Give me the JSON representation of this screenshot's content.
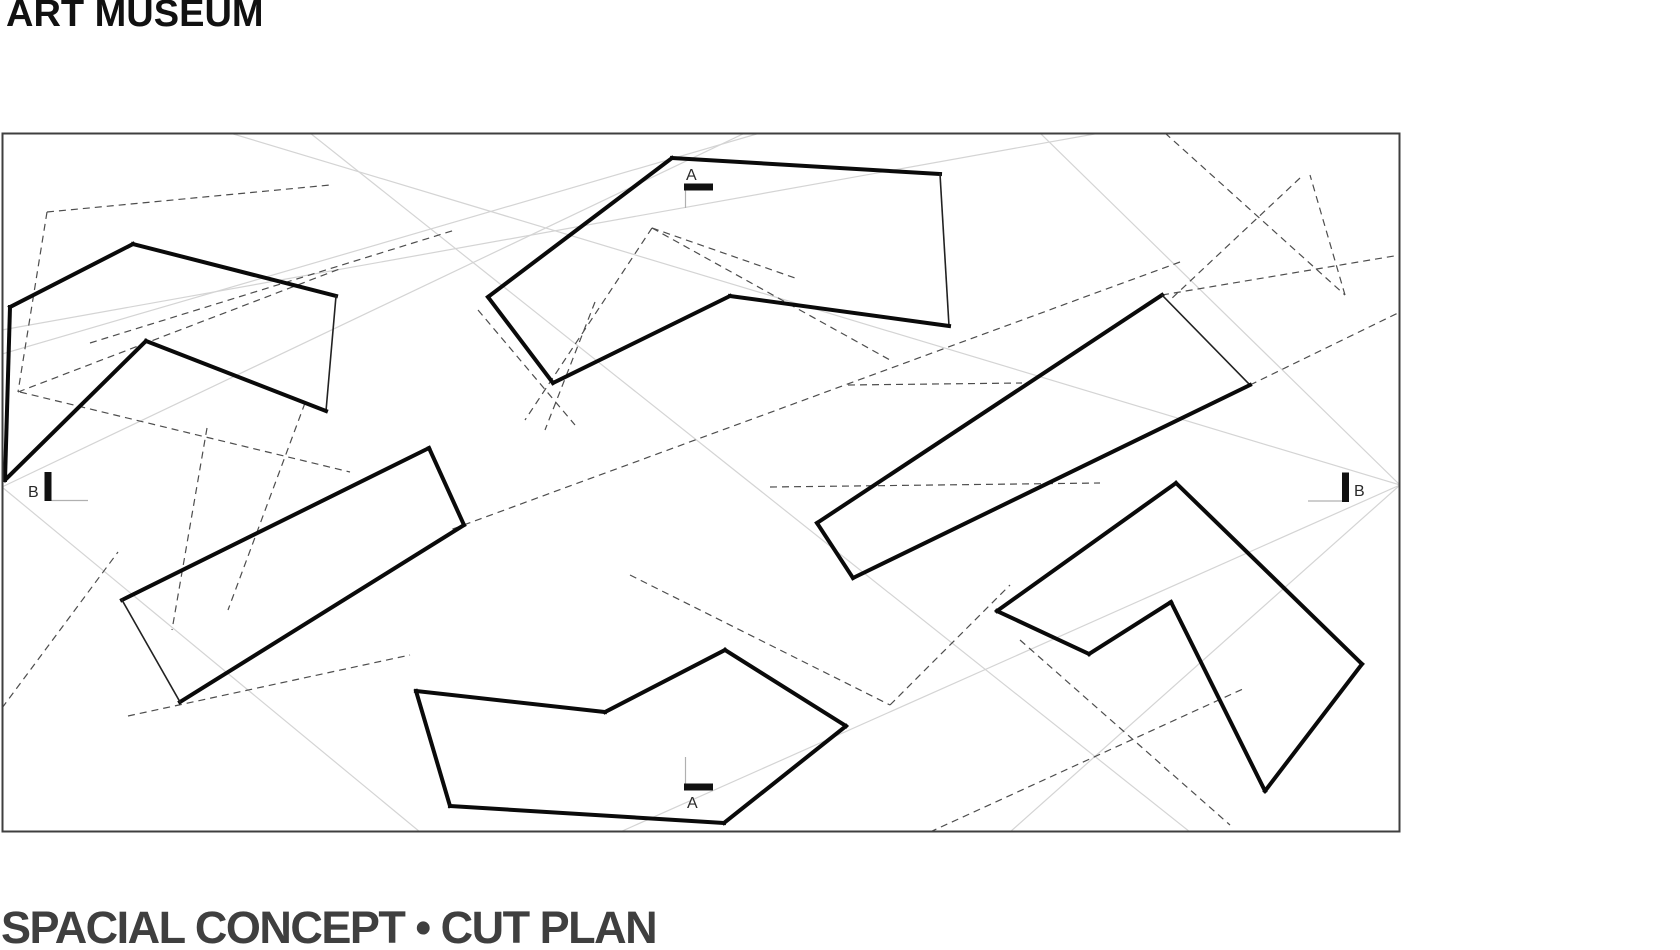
{
  "title": "ART MUSEUM",
  "caption": "SPACIAL CONCEPT • CUT PLAN",
  "colors": {
    "background": "#ffffff",
    "title_text": "#111111",
    "caption_text": "#3f3f3f",
    "frame_stroke": "#3f3f3f",
    "shape_bold_stroke": "#0a0a0a",
    "shape_thin_stroke": "#222222",
    "dashed_line": "#4d4d4d",
    "light_line": "#d4d4d4",
    "marker_bar": "#111111",
    "marker_text": "#2a2a2a",
    "marker_tick": "#b0b0b0"
  },
  "drawing": {
    "canvas": {
      "width": 1680,
      "height": 950
    },
    "frame": {
      "x": 2.5,
      "y": 133.5,
      "width": 1397,
      "height": 698
    },
    "stroke_widths": {
      "bold": 4,
      "thin": 1.6,
      "dashed": 1.2,
      "light": 1.2,
      "frame": 2
    },
    "dash_pattern": "7,5",
    "shapes": [
      {
        "name": "gallery-volume-northwest",
        "vertices": [
          [
            10,
            307
          ],
          [
            133,
            244
          ],
          [
            336,
            296
          ],
          [
            326,
            411
          ],
          [
            146,
            341
          ],
          [
            5,
            480
          ]
        ],
        "thin_edges": [
          2
        ]
      },
      {
        "name": "gallery-volume-north",
        "vertices": [
          [
            672,
            158
          ],
          [
            940,
            174
          ],
          [
            949,
            326
          ],
          [
            730,
            296
          ],
          [
            553,
            383
          ],
          [
            488,
            297
          ]
        ],
        "thin_edges": [
          1
        ]
      },
      {
        "name": "gallery-volume-west",
        "vertices": [
          [
            122,
            600
          ],
          [
            429,
            448
          ],
          [
            464,
            525
          ],
          [
            180,
            702
          ]
        ],
        "thin_edges": [
          3
        ]
      },
      {
        "name": "gallery-volume-east-bar",
        "vertices": [
          [
            817,
            523
          ],
          [
            1162,
            295
          ],
          [
            1250,
            385
          ],
          [
            853,
            578
          ]
        ],
        "thin_edges": [
          1
        ]
      },
      {
        "name": "gallery-volume-southeast",
        "vertices": [
          [
            997,
            611
          ],
          [
            1176,
            483
          ],
          [
            1362,
            664
          ],
          [
            1265,
            791
          ],
          [
            1171,
            602
          ],
          [
            1089,
            654
          ]
        ],
        "thin_edges": []
      },
      {
        "name": "gallery-volume-south",
        "vertices": [
          [
            416,
            691
          ],
          [
            605,
            712
          ],
          [
            725,
            650
          ],
          [
            846,
            726
          ],
          [
            724,
            823
          ],
          [
            450,
            806
          ]
        ],
        "thin_edges": []
      }
    ],
    "light_lines": [
      [
        2,
        487,
        745,
        133
      ],
      [
        2,
        487,
        420,
        832
      ],
      [
        310,
        133,
        1190,
        832
      ],
      [
        1040,
        133,
        1400,
        485
      ],
      [
        2,
        330,
        1100,
        133
      ],
      [
        1400,
        485,
        620,
        832
      ],
      [
        1400,
        485,
        1010,
        832
      ],
      [
        230,
        133,
        1400,
        485
      ],
      [
        2,
        354,
        760,
        133
      ]
    ],
    "dashed_lines": [
      [
        47,
        212,
        18,
        392
      ],
      [
        18,
        392,
        342,
        268
      ],
      [
        47,
        212,
        330,
        185
      ],
      [
        90,
        343,
        455,
        230
      ],
      [
        20,
        392,
        350,
        472
      ],
      [
        652,
        228,
        525,
        420
      ],
      [
        652,
        228,
        795,
        278
      ],
      [
        652,
        228,
        890,
        360
      ],
      [
        1180,
        262,
        450,
        530
      ],
      [
        848,
        385,
        1022,
        383
      ],
      [
        770,
        487,
        1100,
        483
      ],
      [
        630,
        575,
        890,
        705
      ],
      [
        890,
        705,
        1010,
        585
      ],
      [
        930,
        832,
        1245,
        688
      ],
      [
        1020,
        640,
        1230,
        825
      ],
      [
        1165,
        133,
        1345,
        295
      ],
      [
        1345,
        295,
        1310,
        175
      ],
      [
        1300,
        178,
        1170,
        300
      ],
      [
        1250,
        385,
        1400,
        312
      ],
      [
        1162,
        295,
        1400,
        255
      ],
      [
        207,
        428,
        172,
        630
      ],
      [
        305,
        403,
        228,
        610
      ],
      [
        128,
        716,
        410,
        655
      ],
      [
        595,
        302,
        545,
        430
      ],
      [
        478,
        310,
        575,
        425
      ],
      [
        2,
        708,
        118,
        552
      ]
    ],
    "section_markers": [
      {
        "id": "section-marker-a-top",
        "label": "A",
        "label_x": 686,
        "label_y": 180,
        "bar": {
          "x": 684,
          "y": 183.5,
          "width": 29,
          "height": 7
        },
        "tick": [
          685.5,
          190.5,
          685.5,
          208
        ]
      },
      {
        "id": "section-marker-a-bottom",
        "label": "A",
        "label_x": 687,
        "label_y": 808,
        "bar": {
          "x": 684,
          "y": 783.5,
          "width": 29,
          "height": 7
        },
        "tick": [
          685.5,
          757,
          685.5,
          783.5
        ]
      },
      {
        "id": "section-marker-b-left",
        "label": "B",
        "label_x": 28,
        "label_y": 497,
        "bar": {
          "x": 44.5,
          "y": 472,
          "width": 7,
          "height": 29
        },
        "tick": [
          51.5,
          500.5,
          88,
          500.5
        ]
      },
      {
        "id": "section-marker-b-right",
        "label": "B",
        "label_x": 1354,
        "label_y": 496,
        "bar": {
          "x": 1342,
          "y": 472.5,
          "width": 7,
          "height": 29.5
        },
        "tick": [
          1308,
          501,
          1342,
          501
        ]
      }
    ]
  }
}
